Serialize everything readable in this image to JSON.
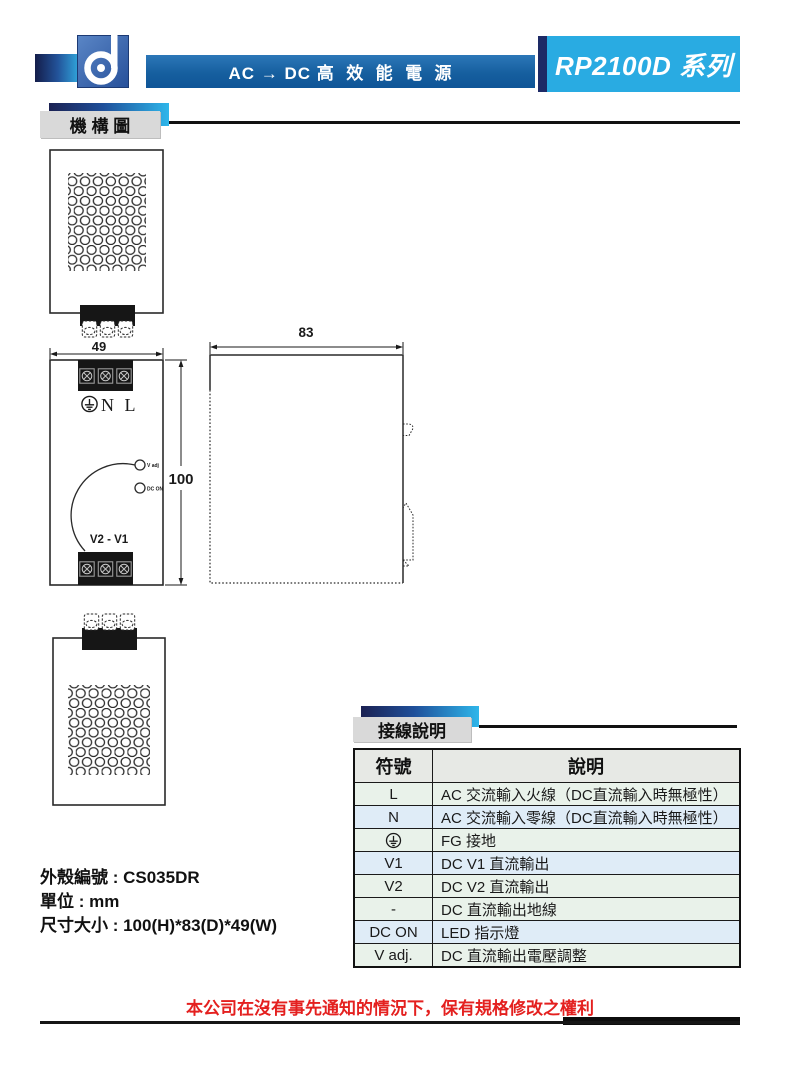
{
  "header": {
    "logo": "d-logo",
    "tagline": "AC → DC 高  效  能  電  源",
    "series_badge": "RP2100D 系列"
  },
  "sections": {
    "mechanical": "機 構 圖",
    "wiring": "接線說明"
  },
  "drawing": {
    "dims": {
      "width": "49",
      "height": "100",
      "depth": "83"
    },
    "front": {
      "input_labels": "N L",
      "output_labels": "V2 - V1",
      "vadj_label": "V adj",
      "dcon_label": "DC ON"
    }
  },
  "info": {
    "case_number": "外殼編號 : CS035DR",
    "unit": "單位 : mm",
    "size": "尺寸大小 : 100(H)*83(D)*49(W)"
  },
  "table": {
    "headers": [
      "符號",
      "說明"
    ],
    "rows": [
      {
        "symbol": "L",
        "desc": "AC 交流輸入火線（DC直流輸入時無極性）",
        "tint": "green"
      },
      {
        "symbol": "N",
        "desc": "AC 交流輸入零線（DC直流輸入時無極性）",
        "tint": "blue"
      },
      {
        "symbol": "",
        "symbol_icon": "earth-ground",
        "desc": "FG 接地",
        "tint": "green"
      },
      {
        "symbol": "V1",
        "desc": "DC V1 直流輸出",
        "tint": "blue"
      },
      {
        "symbol": "V2",
        "desc": "DC V2 直流輸出",
        "tint": "green"
      },
      {
        "symbol": "-",
        "desc": "DC 直流輸出地線",
        "tint": "green"
      },
      {
        "symbol": "DC ON",
        "desc": "LED 指示燈",
        "tint": "blue"
      },
      {
        "symbol": "V adj.",
        "desc": "DC 直流輸出電壓調整",
        "tint": "green"
      }
    ]
  },
  "footer": {
    "disclaimer": "本公司在沒有事先通知的情況下，保有規格修改之權利"
  },
  "colors": {
    "accent_cyan": "#29abe2",
    "navy": "#1d2a66",
    "bar_blue": "#1563a9",
    "alert_red": "#e4201f",
    "row_green": "#e9f2ea",
    "row_blue": "#dfecf7",
    "header_gray": "#e7e9e5"
  }
}
